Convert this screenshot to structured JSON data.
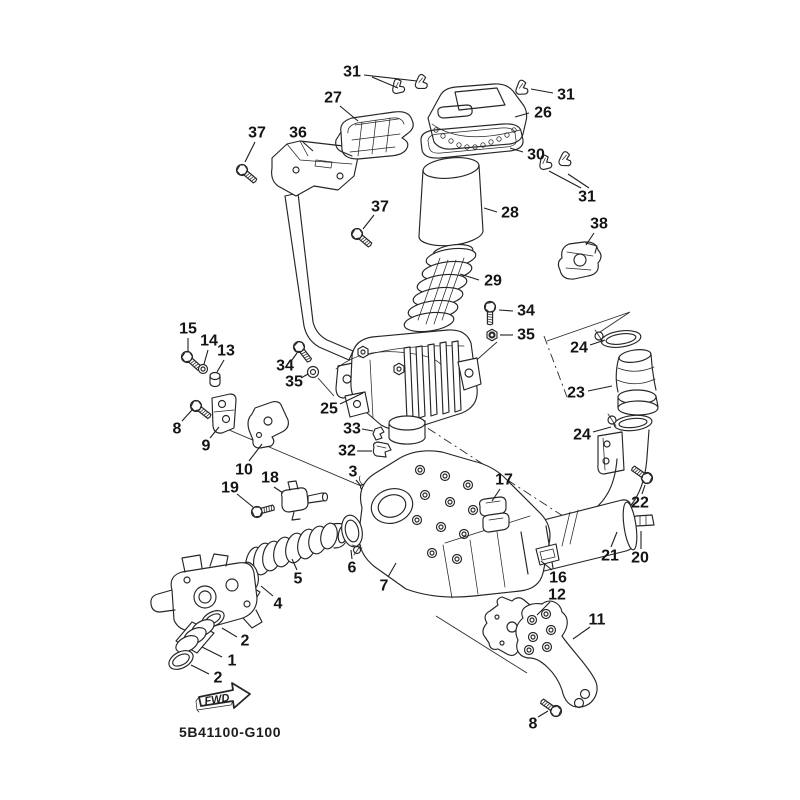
{
  "diagram": {
    "code": "5B41100-G100",
    "fwd_label": "FWD",
    "colors": {
      "line": "#262626",
      "background": "#ffffff"
    },
    "callouts": [
      {
        "n": "31",
        "x": 352,
        "y": 72,
        "leaders": [
          [
            364,
            75,
            417,
            81
          ],
          [
            372,
            77,
            398,
            88
          ]
        ]
      },
      {
        "n": "27",
        "x": 333,
        "y": 98,
        "leaders": [
          [
            340,
            106,
            358,
            121
          ]
        ]
      },
      {
        "n": "26",
        "x": 543,
        "y": 113,
        "leaders": [
          [
            529,
            113,
            515,
            117
          ]
        ]
      },
      {
        "n": "31",
        "x": 566,
        "y": 95,
        "leaders": [
          [
            553,
            93,
            531,
            89
          ]
        ]
      },
      {
        "n": "30",
        "x": 536,
        "y": 155,
        "leaders": [
          [
            523,
            152,
            510,
            148
          ]
        ]
      },
      {
        "n": "28",
        "x": 510,
        "y": 213,
        "leaders": [
          [
            497,
            212,
            484,
            208
          ]
        ]
      },
      {
        "n": "37",
        "x": 257,
        "y": 133,
        "leaders": [
          [
            255,
            142,
            245,
            162
          ]
        ]
      },
      {
        "n": "36",
        "x": 298,
        "y": 133,
        "leaders": [
          [
            303,
            142,
            313,
            151
          ]
        ]
      },
      {
        "n": "37",
        "x": 380,
        "y": 207,
        "leaders": [
          [
            374,
            215,
            363,
            229
          ]
        ]
      },
      {
        "n": "31",
        "x": 587,
        "y": 197,
        "leaders": [
          [
            581,
            188,
            549,
            171
          ],
          [
            589,
            188,
            568,
            174
          ]
        ]
      },
      {
        "n": "38",
        "x": 599,
        "y": 224,
        "leaders": [
          [
            594,
            233,
            586,
            245
          ]
        ]
      },
      {
        "n": "29",
        "x": 493,
        "y": 281,
        "leaders": [
          [
            479,
            280,
            460,
            274
          ]
        ]
      },
      {
        "n": "34",
        "x": 526,
        "y": 311,
        "leaders": [
          [
            513,
            311,
            499,
            310
          ]
        ]
      },
      {
        "n": "35",
        "x": 526,
        "y": 335,
        "leaders": [
          [
            513,
            335,
            500,
            335
          ]
        ]
      },
      {
        "n": "34",
        "x": 285,
        "y": 366,
        "leaders": [
          [
            292,
            360,
            297,
            353
          ]
        ]
      },
      {
        "n": "35",
        "x": 294,
        "y": 382,
        "leaders": [
          [
            301,
            378,
            308,
            374
          ]
        ]
      },
      {
        "n": "25",
        "x": 329,
        "y": 409,
        "leaders": [
          [
            340,
            404,
            363,
            393
          ]
        ]
      },
      {
        "n": "33",
        "x": 352,
        "y": 429,
        "leaders": [
          [
            362,
            429,
            373,
            431
          ]
        ]
      },
      {
        "n": "32",
        "x": 347,
        "y": 451,
        "leaders": [
          [
            357,
            451,
            372,
            451
          ]
        ]
      },
      {
        "n": "24",
        "x": 579,
        "y": 348,
        "leaders": [
          [
            590,
            345,
            605,
            340
          ]
        ]
      },
      {
        "n": "23",
        "x": 576,
        "y": 393,
        "leaders": [
          [
            588,
            391,
            612,
            386
          ]
        ]
      },
      {
        "n": "24",
        "x": 582,
        "y": 435,
        "leaders": [
          [
            593,
            432,
            611,
            427
          ]
        ]
      },
      {
        "n": "22",
        "x": 640,
        "y": 503,
        "leaders": [
          [
            642,
            494,
            645,
            485
          ]
        ]
      },
      {
        "n": "21",
        "x": 610,
        "y": 556,
        "leaders": [
          [
            611,
            547,
            617,
            532
          ]
        ]
      },
      {
        "n": "20",
        "x": 640,
        "y": 558,
        "leaders": [
          [
            641,
            549,
            641,
            531
          ]
        ]
      },
      {
        "n": "15",
        "x": 188,
        "y": 329,
        "leaders": [
          [
            188,
            338,
            188,
            352
          ]
        ]
      },
      {
        "n": "14",
        "x": 209,
        "y": 341,
        "leaders": [
          [
            208,
            350,
            204,
            364
          ]
        ]
      },
      {
        "n": "13",
        "x": 226,
        "y": 351,
        "leaders": [
          [
            224,
            360,
            217,
            372
          ]
        ]
      },
      {
        "n": "8",
        "x": 177,
        "y": 429,
        "leaders": [
          [
            182,
            421,
            192,
            410
          ]
        ]
      },
      {
        "n": "9",
        "x": 206,
        "y": 446,
        "leaders": [
          [
            210,
            438,
            219,
            427
          ]
        ]
      },
      {
        "n": "10",
        "x": 244,
        "y": 470,
        "leaders": [
          [
            249,
            461,
            262,
            444
          ]
        ]
      },
      {
        "n": "18",
        "x": 270,
        "y": 478,
        "leaders": [
          [
            274,
            487,
            283,
            493
          ]
        ]
      },
      {
        "n": "19",
        "x": 230,
        "y": 488,
        "leaders": [
          [
            237,
            494,
            253,
            507
          ]
        ]
      },
      {
        "n": "3",
        "x": 353,
        "y": 472,
        "leaders": [
          [
            356,
            480,
            361,
            486
          ]
        ]
      },
      {
        "n": "17",
        "x": 504,
        "y": 480,
        "leaders": [
          [
            500,
            489,
            492,
            501
          ]
        ]
      },
      {
        "n": "5",
        "x": 298,
        "y": 579,
        "leaders": [
          [
            297,
            570,
            292,
            559
          ]
        ]
      },
      {
        "n": "6",
        "x": 352,
        "y": 568,
        "leaders": [
          [
            352,
            559,
            351,
            550
          ]
        ]
      },
      {
        "n": "7",
        "x": 384,
        "y": 586,
        "leaders": [
          [
            388,
            577,
            396,
            563
          ]
        ]
      },
      {
        "n": "4",
        "x": 278,
        "y": 604,
        "leaders": [
          [
            273,
            596,
            261,
            586
          ]
        ]
      },
      {
        "n": "2",
        "x": 245,
        "y": 641,
        "leaders": [
          [
            237,
            637,
            222,
            628
          ]
        ]
      },
      {
        "n": "1",
        "x": 232,
        "y": 661,
        "leaders": [
          [
            222,
            657,
            202,
            647
          ]
        ]
      },
      {
        "n": "2",
        "x": 218,
        "y": 678,
        "leaders": [
          [
            209,
            674,
            191,
            665
          ]
        ]
      },
      {
        "n": "16",
        "x": 558,
        "y": 578,
        "leaders": [
          [
            552,
            570,
            541,
            561
          ]
        ]
      },
      {
        "n": "12",
        "x": 557,
        "y": 595,
        "leaders": [
          [
            550,
            602,
            537,
            615
          ]
        ]
      },
      {
        "n": "11",
        "x": 597,
        "y": 620,
        "leaders": [
          [
            590,
            627,
            573,
            639
          ]
        ]
      },
      {
        "n": "8",
        "x": 533,
        "y": 724,
        "leaders": [
          [
            538,
            717,
            548,
            711
          ]
        ]
      }
    ]
  }
}
